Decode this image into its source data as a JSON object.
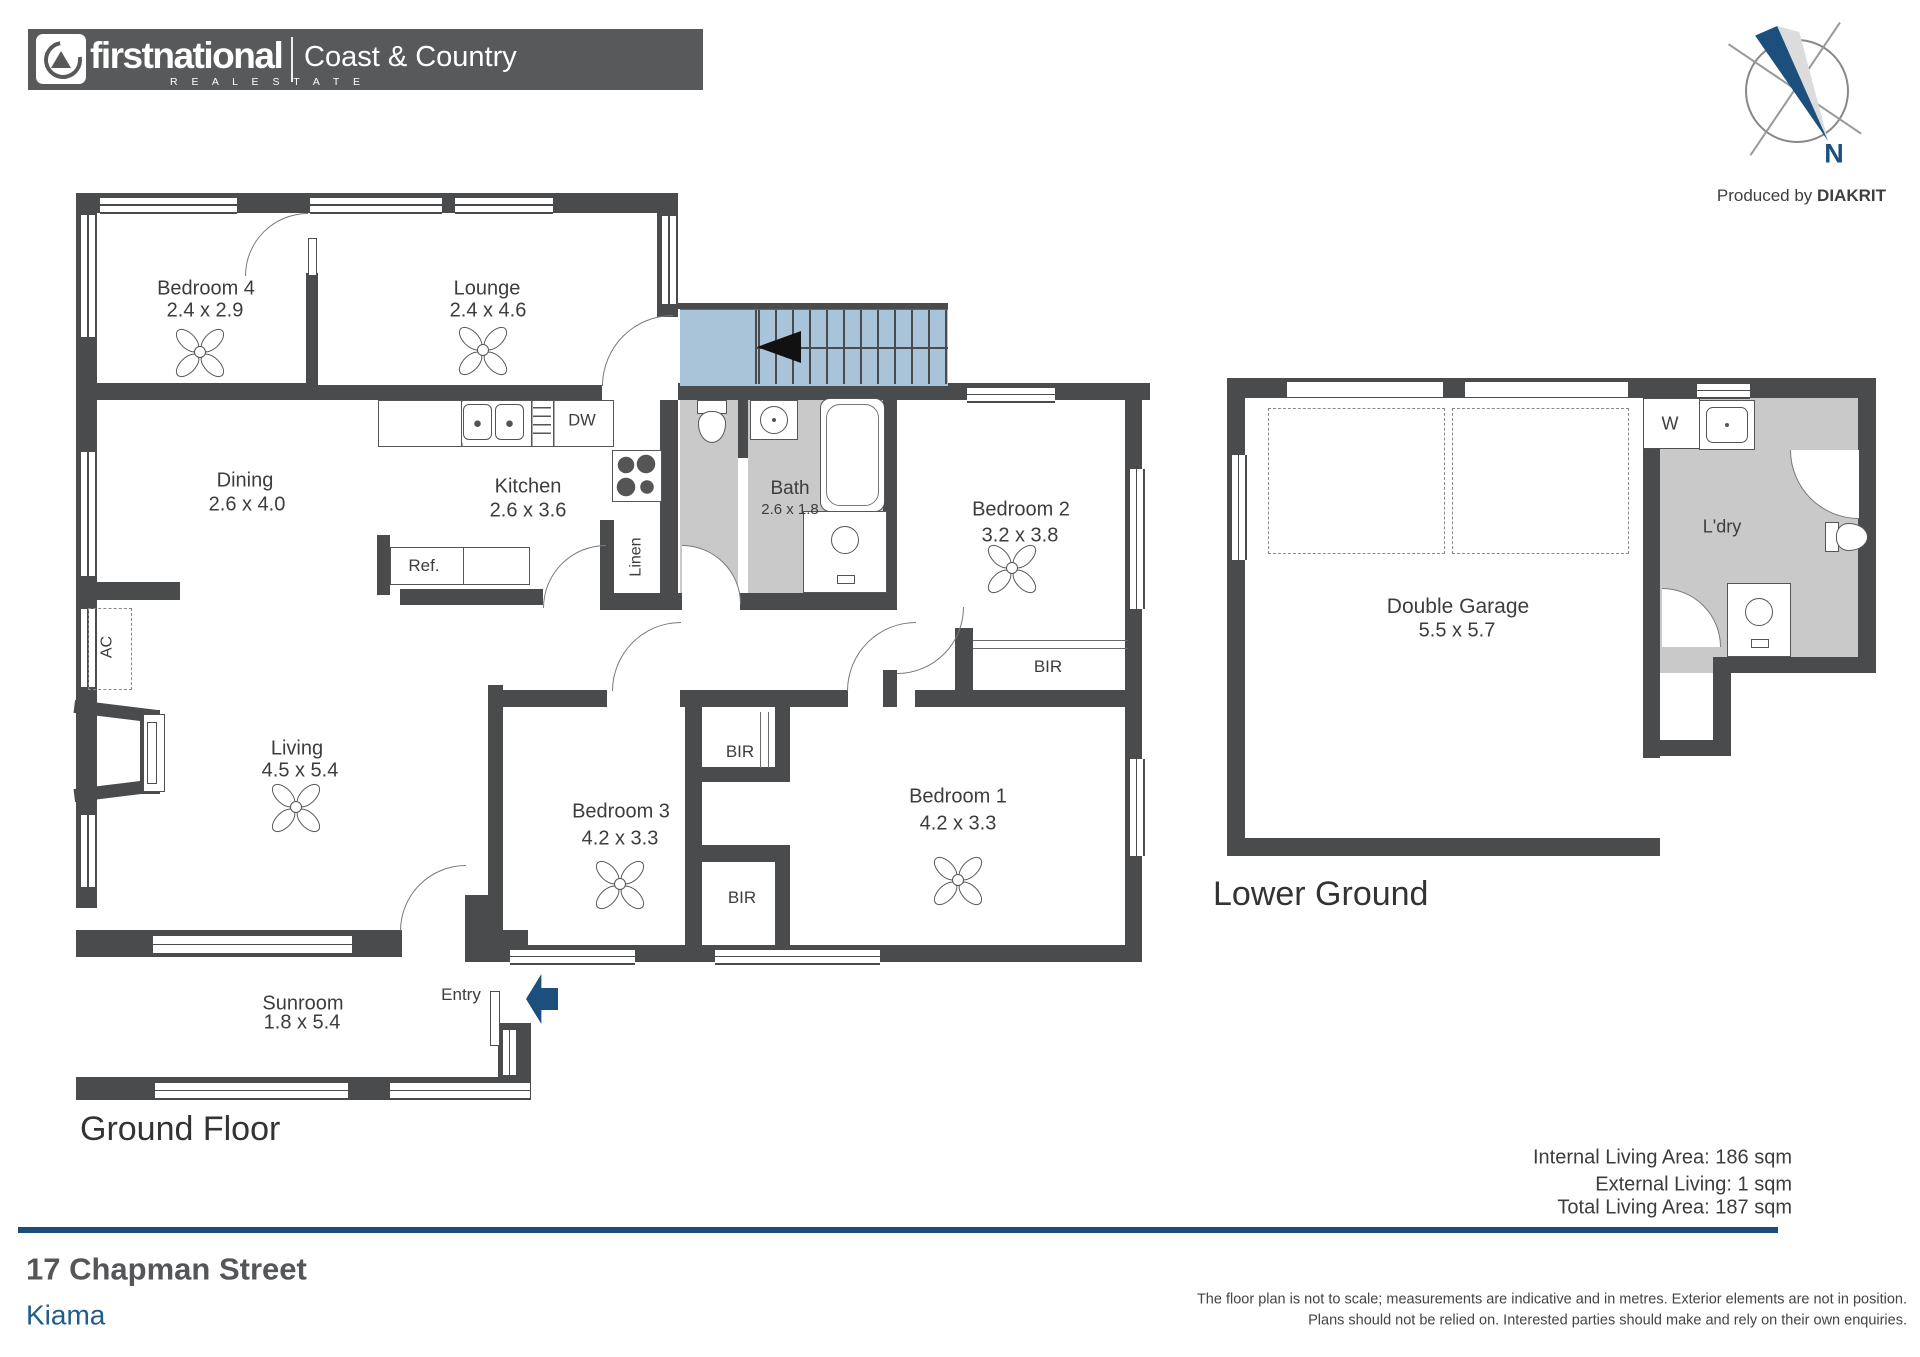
{
  "header": {
    "brand_first": "firstnational",
    "brand_sub": "R E A L   E S T A T E",
    "office": "Coast & Country"
  },
  "compass": {
    "n": "N",
    "credit_regular": "Produced by ",
    "credit_bold": "DIAKRIT"
  },
  "titles": {
    "ground": "Ground Floor",
    "lower": "Lower Ground"
  },
  "areas": {
    "internal": "Internal Living Area: 186 sqm",
    "external": "External Living: 1 sqm",
    "total": "Total Living Area: 187 sqm"
  },
  "address": {
    "street": "17 Chapman Street",
    "suburb": "Kiama"
  },
  "disclaimer": {
    "line1": "The floor plan is not to scale; measurements are indicative and in metres. Exterior elements are not in position.",
    "line2": "Plans should not be relied on. Interested parties should make and rely on their own enquiries."
  },
  "colors": {
    "wall": "#4a4b4d",
    "stair": "#a9c3d9",
    "navy": "#1d4f7c",
    "blueline": "#1a4e78",
    "gray": "#c9c9c9",
    "kiama": "#1f5c8b"
  },
  "plan": {
    "grays": [
      [
        680,
        400,
        58,
        193
      ],
      [
        748,
        400,
        135,
        193
      ],
      [
        1660,
        398,
        198,
        275
      ]
    ],
    "walls": [
      [
        76,
        193,
        602,
        20
      ],
      [
        76,
        193,
        21,
        715
      ],
      [
        306,
        273,
        12,
        110
      ],
      [
        76,
        383,
        242,
        17
      ],
      [
        657,
        193,
        21,
        124
      ],
      [
        318,
        385,
        284,
        15
      ],
      [
        678,
        383,
        472,
        17
      ],
      [
        660,
        400,
        18,
        193
      ],
      [
        738,
        400,
        10,
        58
      ],
      [
        883,
        400,
        14,
        207
      ],
      [
        883,
        670,
        14,
        37
      ],
      [
        600,
        520,
        14,
        75
      ],
      [
        600,
        593,
        82,
        17
      ],
      [
        740,
        593,
        157,
        17
      ],
      [
        400,
        589,
        143,
        16
      ],
      [
        377,
        535,
        13,
        60
      ],
      [
        76,
        582,
        104,
        18
      ],
      [
        488,
        685,
        15,
        277
      ],
      [
        465,
        895,
        23,
        67
      ],
      [
        488,
        690,
        119,
        17
      ],
      [
        680,
        690,
        22,
        17
      ],
      [
        702,
        690,
        146,
        17
      ],
      [
        915,
        690,
        227,
        17
      ],
      [
        685,
        702,
        17,
        243
      ],
      [
        775,
        707,
        15,
        70
      ],
      [
        702,
        767,
        88,
        15
      ],
      [
        702,
        845,
        88,
        17
      ],
      [
        775,
        862,
        15,
        83
      ],
      [
        955,
        628,
        18,
        76
      ],
      [
        1125,
        383,
        17,
        579
      ],
      [
        488,
        945,
        654,
        17
      ],
      [
        76,
        930,
        326,
        27
      ],
      [
        465,
        930,
        63,
        27
      ],
      [
        76,
        1077,
        455,
        23
      ],
      [
        498,
        1023,
        33,
        54
      ],
      [
        140,
        710,
        20,
        84
      ],
      [
        1227,
        378,
        649,
        20
      ],
      [
        1227,
        378,
        18,
        478
      ],
      [
        1858,
        378,
        18,
        295
      ],
      [
        1643,
        398,
        17,
        360
      ],
      [
        1713,
        657,
        163,
        16
      ],
      [
        1713,
        673,
        18,
        83
      ],
      [
        1643,
        740,
        88,
        16
      ],
      [
        1227,
        838,
        433,
        18
      ]
    ],
    "rotWalls": [
      [
        74,
        705,
        84,
        13,
        7
      ],
      [
        74,
        784,
        84,
        13,
        -7
      ]
    ],
    "whiteRects": [
      [
        1287,
        381,
        156,
        16
      ],
      [
        1465,
        381,
        163,
        16
      ]
    ],
    "lines": [
      [
        1287,
        379,
        156,
        3
      ],
      [
        1465,
        379,
        163,
        3
      ],
      [
        678,
        303,
        270,
        6
      ],
      [
        942,
        303,
        6,
        82
      ]
    ],
    "windowsH": [
      [
        100,
        196,
        137,
        14
      ],
      [
        310,
        196,
        132,
        14
      ],
      [
        455,
        196,
        98,
        14
      ],
      [
        967,
        386,
        88,
        13
      ],
      [
        153,
        934,
        199,
        17
      ],
      [
        510,
        948,
        125,
        13
      ],
      [
        715,
        948,
        165,
        13
      ],
      [
        155,
        1081,
        193,
        15
      ],
      [
        390,
        1081,
        140,
        15
      ],
      [
        1697,
        382,
        53,
        13
      ]
    ],
    "windowsV": [
      [
        79,
        215,
        14,
        122
      ],
      [
        79,
        452,
        14,
        124
      ],
      [
        79,
        609,
        14,
        78
      ],
      [
        79,
        815,
        14,
        72
      ],
      [
        660,
        216,
        14,
        88
      ],
      [
        1128,
        469,
        13,
        140
      ],
      [
        1128,
        759,
        13,
        97
      ],
      [
        501,
        1030,
        13,
        45
      ],
      [
        1230,
        455,
        13,
        105
      ]
    ],
    "boxes": [
      [
        143,
        714,
        20,
        76
      ],
      [
        147,
        722,
        8,
        60
      ],
      [
        308,
        238,
        7,
        36
      ],
      [
        490,
        991,
        8,
        53
      ],
      [
        1643,
        398,
        55,
        49
      ]
    ],
    "dashed": [
      [
        88,
        608,
        42,
        80
      ],
      [
        1268,
        408,
        175,
        144
      ],
      [
        1452,
        408,
        175,
        144
      ]
    ],
    "doors": [
      {
        "x": 245,
        "y": 213,
        "s": 62,
        "c": "tl",
        "f": 0
      },
      {
        "x": 602,
        "y": 315,
        "s": 70,
        "c": "tl",
        "f": 0
      },
      {
        "x": 543,
        "y": 545,
        "s": 62,
        "c": "tl",
        "f": 0
      },
      {
        "x": 682,
        "y": 545,
        "s": 58,
        "c": "tr",
        "f": 1
      },
      {
        "x": 897,
        "y": 607,
        "s": 66,
        "c": "br",
        "f": 0
      },
      {
        "x": 612,
        "y": 622,
        "s": 68,
        "c": "tl",
        "f": 0
      },
      {
        "x": 847,
        "y": 622,
        "s": 68,
        "c": "tl",
        "f": 0
      },
      {
        "x": 400,
        "y": 865,
        "s": 65,
        "c": "tl",
        "f": 0
      },
      {
        "x": 1790,
        "y": 450,
        "s": 68,
        "c": "bl",
        "f": 1
      },
      {
        "x": 1662,
        "y": 588,
        "s": 58,
        "c": "tr",
        "f": 1
      }
    ],
    "polesH": [
      [
        973,
        640,
        155
      ]
    ],
    "polesV": [
      [
        760,
        712,
        56
      ]
    ],
    "fans": [
      [
        200,
        352
      ],
      [
        483,
        350
      ],
      [
        296,
        807
      ],
      [
        620,
        884
      ],
      [
        958,
        880
      ],
      [
        1012,
        568
      ]
    ],
    "fixtures": [
      {
        "t": "bench",
        "x": 378,
        "y": 400,
        "w": 234,
        "h": 45
      },
      {
        "t": "sink2",
        "x": 462,
        "y": 402,
        "w": 64,
        "h": 41
      },
      {
        "t": "drain",
        "x": 533,
        "y": 407,
        "w": 18,
        "h": 31
      },
      {
        "t": "stove",
        "x": 612,
        "y": 450,
        "w": 48,
        "h": 50
      },
      {
        "t": "ref",
        "x": 390,
        "y": 547,
        "w": 138,
        "h": 36
      },
      {
        "t": "toilet",
        "x": 694,
        "y": 400,
        "w": 36,
        "h": 46,
        "r": 0
      },
      {
        "t": "basin",
        "x": 750,
        "y": 400,
        "w": 46,
        "h": 38
      },
      {
        "t": "tub",
        "x": 820,
        "y": 398,
        "w": 63,
        "h": 112
      },
      {
        "t": "shower",
        "x": 803,
        "y": 511,
        "w": 82,
        "h": 80
      },
      {
        "t": "ltub",
        "x": 1699,
        "y": 400,
        "w": 54,
        "h": 48
      },
      {
        "t": "toilet",
        "x": 1830,
        "y": 514,
        "w": 36,
        "h": 46,
        "r": -90
      },
      {
        "t": "shower",
        "x": 1727,
        "y": 583,
        "w": 62,
        "h": 72
      }
    ],
    "stairs": {
      "x": 680,
      "y": 309,
      "w": 268,
      "h": 76,
      "tread0": 758,
      "gap": 17,
      "landing": 755
    },
    "stairArrow": {
      "x": 757,
      "y": 331,
      "w": 44,
      "h": 32
    },
    "entryArrow": {
      "x": 526,
      "y": 974,
      "w": 32,
      "h": 50
    },
    "labels": [
      {
        "n": "label-bedroom-4",
        "t": "Bedroom 4",
        "x": 206,
        "y": 289,
        "fs": 20
      },
      {
        "n": "label-bedroom-4-dims",
        "t": "2.4 x 2.9",
        "x": 205,
        "y": 311,
        "fs": 20
      },
      {
        "n": "label-lounge",
        "t": "Lounge",
        "x": 487,
        "y": 289,
        "fs": 20
      },
      {
        "n": "label-lounge-dims",
        "t": "2.4 x 4.6",
        "x": 488,
        "y": 311,
        "fs": 20
      },
      {
        "n": "label-dining",
        "t": "Dining",
        "x": 245,
        "y": 481,
        "fs": 20
      },
      {
        "n": "label-dining-dims",
        "t": "2.6 x 4.0",
        "x": 247,
        "y": 505,
        "fs": 20
      },
      {
        "n": "label-kitchen",
        "t": "Kitchen",
        "x": 528,
        "y": 487,
        "fs": 20
      },
      {
        "n": "label-kitchen-dims",
        "t": "2.6 x 3.6",
        "x": 528,
        "y": 511,
        "fs": 20
      },
      {
        "n": "label-bath",
        "t": "Bath",
        "x": 790,
        "y": 489,
        "fs": 19
      },
      {
        "n": "label-bath-dims",
        "t": "2.6 x 1.8",
        "x": 790,
        "y": 510,
        "fs": 15
      },
      {
        "n": "label-bedroom-2",
        "t": "Bedroom 2",
        "x": 1021,
        "y": 510,
        "fs": 20
      },
      {
        "n": "label-bedroom-2-dims",
        "t": "3.2 x 3.8",
        "x": 1020,
        "y": 536,
        "fs": 20
      },
      {
        "n": "label-living",
        "t": "Living",
        "x": 297,
        "y": 749,
        "fs": 20
      },
      {
        "n": "label-living-dims",
        "t": "4.5 x 5.4",
        "x": 300,
        "y": 771,
        "fs": 20
      },
      {
        "n": "label-bedroom-3",
        "t": "Bedroom 3",
        "x": 621,
        "y": 812,
        "fs": 20
      },
      {
        "n": "label-bedroom-3-dims",
        "t": "4.2 x 3.3",
        "x": 620,
        "y": 839,
        "fs": 20
      },
      {
        "n": "label-bedroom-1",
        "t": "Bedroom 1",
        "x": 958,
        "y": 797,
        "fs": 20
      },
      {
        "n": "label-bedroom-1-dims",
        "t": "4.2 x 3.3",
        "x": 958,
        "y": 824,
        "fs": 20
      },
      {
        "n": "label-sunroom",
        "t": "Sunroom",
        "x": 303,
        "y": 1004,
        "fs": 20
      },
      {
        "n": "label-sunroom-dims",
        "t": "1.8 x 5.4",
        "x": 302,
        "y": 1023,
        "fs": 20
      },
      {
        "n": "label-double-garage",
        "t": "Double Garage",
        "x": 1458,
        "y": 607,
        "fs": 21
      },
      {
        "n": "label-double-garage-dims",
        "t": "5.5 x 5.7",
        "x": 1457,
        "y": 631,
        "fs": 20
      },
      {
        "n": "label-dw",
        "t": "DW",
        "x": 582,
        "y": 421,
        "fs": 16.5
      },
      {
        "n": "label-ref",
        "t": "Ref.",
        "x": 424,
        "y": 566,
        "fs": 17
      },
      {
        "n": "label-linen",
        "t": "Linen",
        "x": 637,
        "y": 557,
        "fs": 16,
        "rot": 1
      },
      {
        "n": "label-ac",
        "t": "AC",
        "x": 108,
        "y": 647,
        "fs": 16,
        "rot": 1
      },
      {
        "n": "label-bir-bed2",
        "t": "BIR",
        "x": 1048,
        "y": 667,
        "fs": 17
      },
      {
        "n": "label-bir-upper",
        "t": "BIR",
        "x": 740,
        "y": 752,
        "fs": 17
      },
      {
        "n": "label-bir-lower",
        "t": "BIR",
        "x": 742,
        "y": 898,
        "fs": 17
      },
      {
        "n": "label-entry",
        "t": "Entry",
        "x": 461,
        "y": 995,
        "fs": 17
      },
      {
        "n": "label-w",
        "t": "W",
        "x": 1670,
        "y": 424,
        "fs": 18
      },
      {
        "n": "label-ldry",
        "t": "L'dry",
        "x": 1722,
        "y": 527,
        "fs": 18
      }
    ]
  }
}
